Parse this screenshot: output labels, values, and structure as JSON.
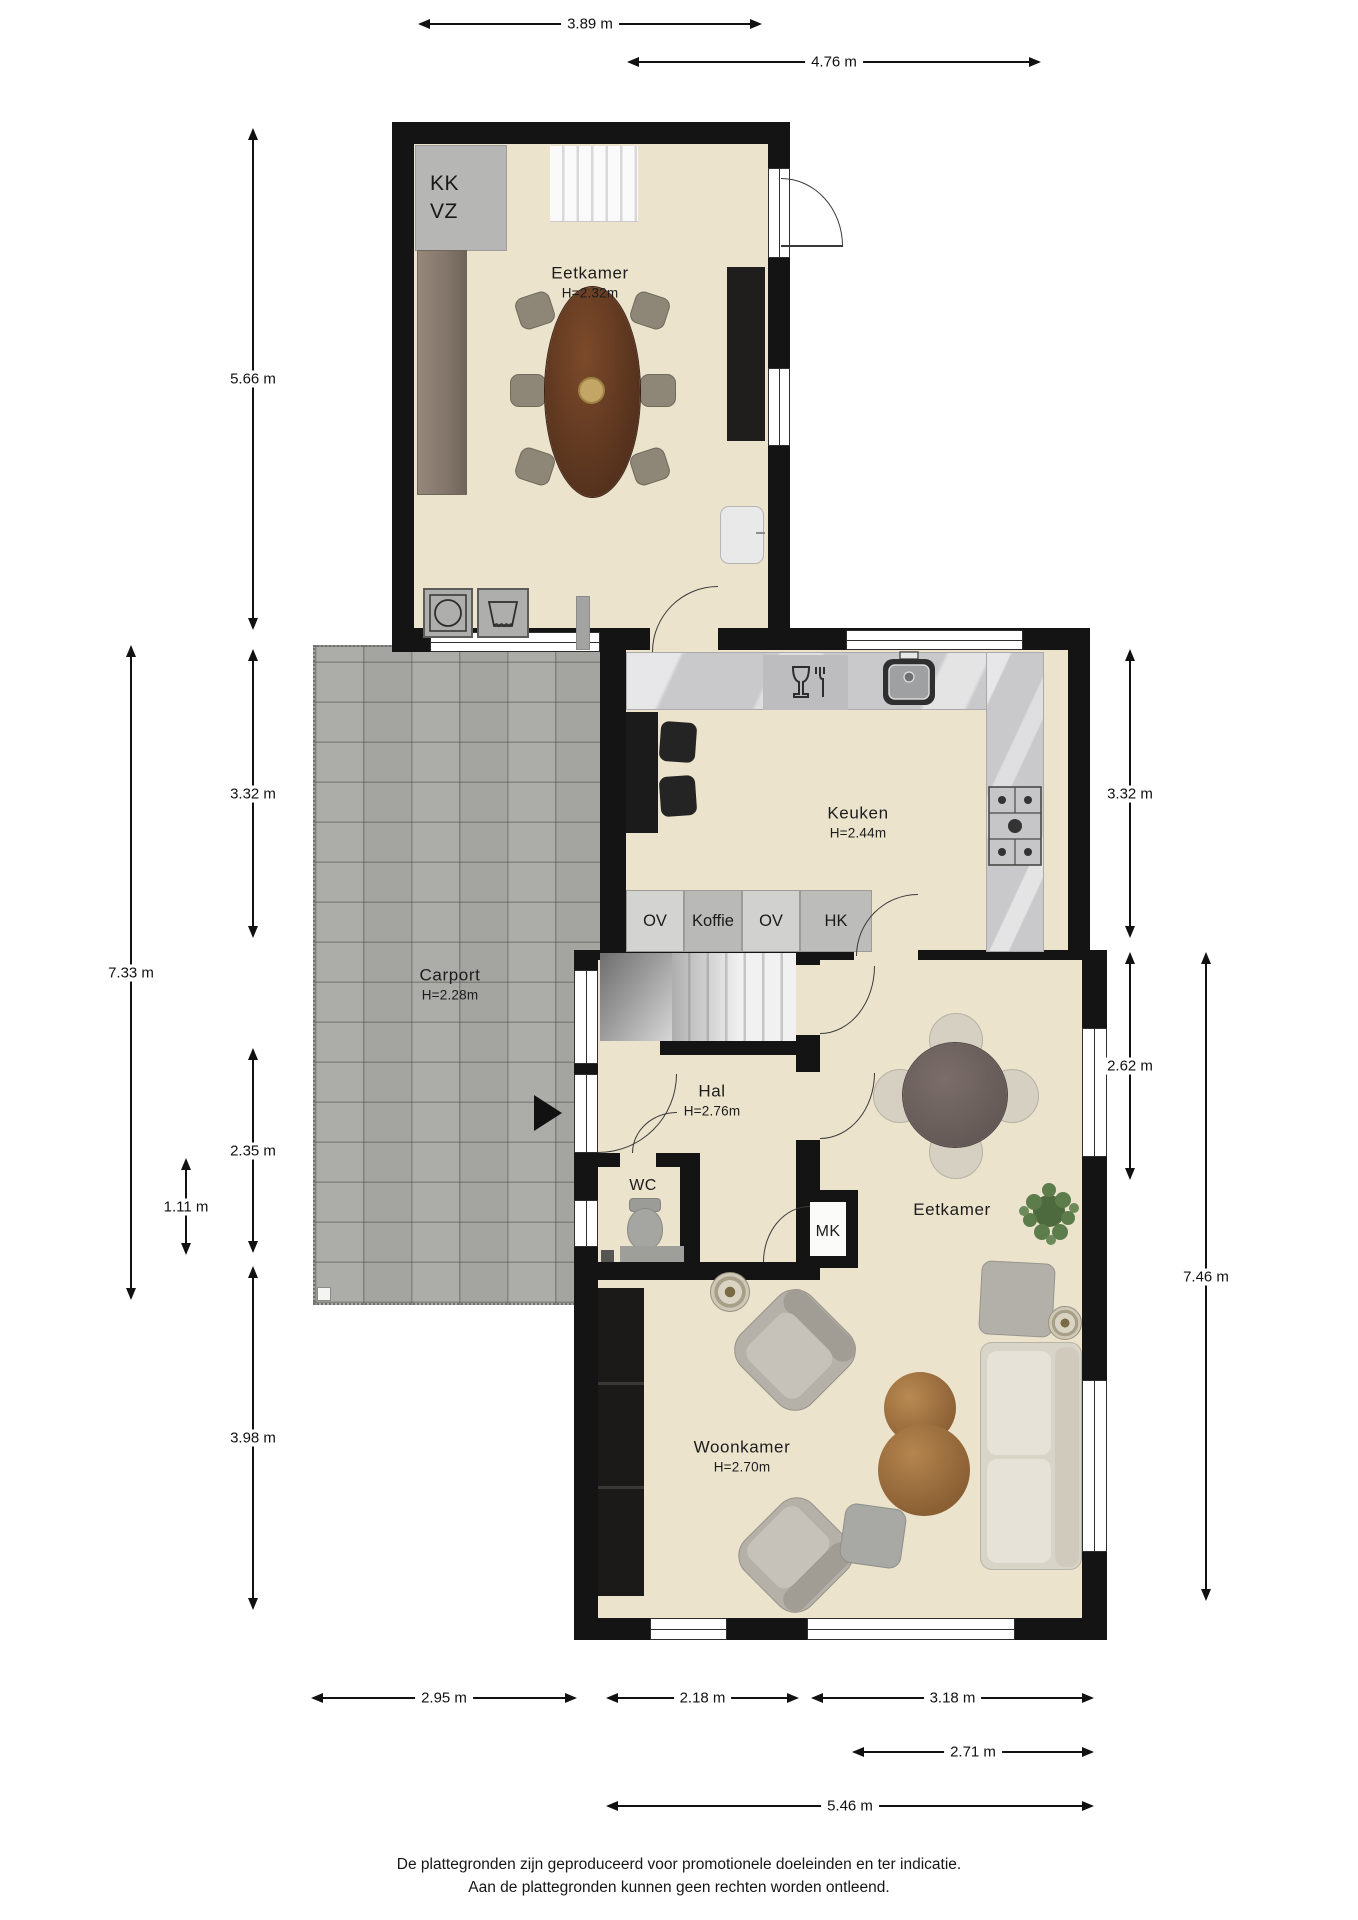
{
  "rooms": {
    "dining_top": {
      "name": "Eetkamer",
      "height": "H=2.32m"
    },
    "kitchen": {
      "name": "Keuken",
      "height": "H=2.44m"
    },
    "carport": {
      "name": "Carport",
      "height": "H=2.28m"
    },
    "hall": {
      "name": "Hal",
      "height": "H=2.76m"
    },
    "wc": {
      "name": "WC"
    },
    "mk": {
      "name": "MK"
    },
    "dining": {
      "name": "Eetkamer"
    },
    "living": {
      "name": "Woonkamer",
      "height": "H=2.70m"
    }
  },
  "cabinets": {
    "kk": "KK",
    "vz": "VZ",
    "ov1": "OV",
    "koffie": "Koffie",
    "ov2": "OV",
    "hk": "HK"
  },
  "dimensions": {
    "top": [
      {
        "label": "3.89 m"
      },
      {
        "label": "4.76 m"
      }
    ],
    "left": [
      {
        "label": "5.66 m"
      },
      {
        "label": "3.32 m"
      },
      {
        "label": "7.33 m"
      },
      {
        "label": "2.35 m"
      },
      {
        "label": "1.11 m"
      },
      {
        "label": "3.98 m"
      }
    ],
    "right": [
      {
        "label": "3.32 m"
      },
      {
        "label": "2.62 m"
      },
      {
        "label": "7.46 m"
      }
    ],
    "bottom": [
      {
        "label": "2.95 m"
      },
      {
        "label": "2.18 m"
      },
      {
        "label": "3.18 m"
      },
      {
        "label": "2.71 m"
      },
      {
        "label": "5.46 m"
      }
    ]
  },
  "disclaimer": {
    "line1": "De plattegronden zijn geproduceerd voor promotionele doeleinden en ter indicatie.",
    "line2": "Aan de plattegronden kunnen geen rechten worden ontleend."
  },
  "colors": {
    "wall": "#141414",
    "floor": "#ece3cd",
    "carport_paving": "#a9a9a5",
    "counter": "#c9c9cb",
    "table_wood": "#5d3a24"
  }
}
